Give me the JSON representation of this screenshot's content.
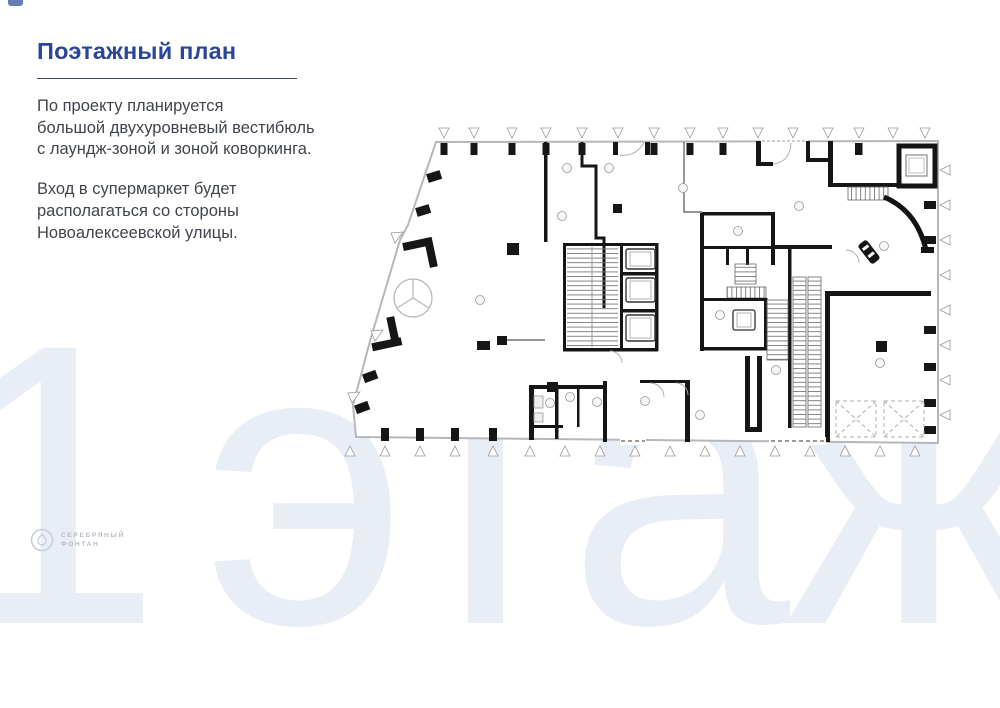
{
  "slide": {
    "title": "Поэтажный план",
    "intro": {
      "lines": [
        "По проекту планируется",
        "большой двухуровневый вестибюль",
        "с лаундж-зоной и зоной коворкинга."
      ]
    },
    "entrance_note": {
      "lines": [
        "Вход в супермаркет будет",
        "располагаться со стороны",
        "Новоалексеевской улицы."
      ]
    },
    "watermark": "1 этаж",
    "logo": {
      "line1": "СЕРЕБРЯНЫЙ",
      "line2": "ФОНТАН"
    }
  },
  "colors": {
    "title_blue": "#2a4599",
    "body_text": "#40444c",
    "underline": "#3c4a68",
    "watermark": "#e9edf5",
    "accent_mark": "#4a66ad",
    "plan_walls": "#161616",
    "plan_glass_outline": "#b4b7bc"
  }
}
